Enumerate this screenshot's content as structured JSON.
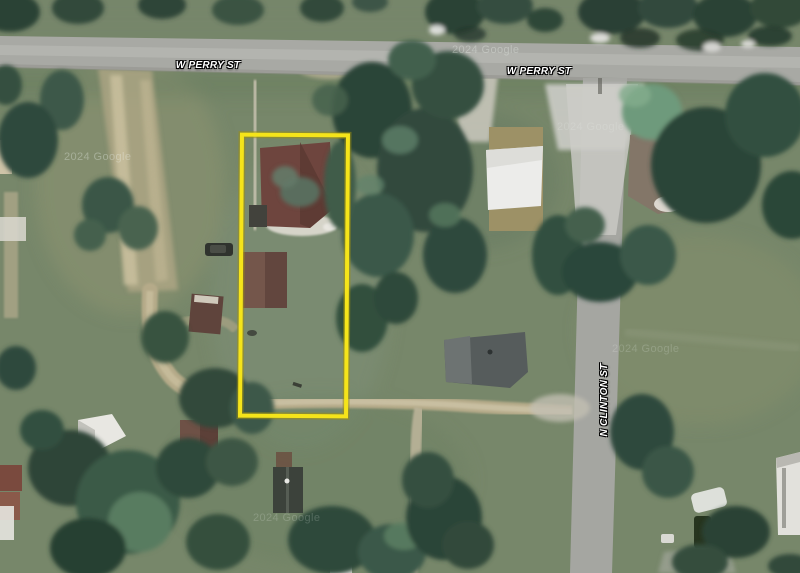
{
  "view": {
    "type": "satellite-map",
    "zoom": "parcel-level aerial imagery"
  },
  "labels": {
    "street_labels": [
      {
        "id": "w-perry-st-west",
        "text": "W PERRY ST",
        "orientation": "horizontal"
      },
      {
        "id": "w-perry-st-east",
        "text": "W PERRY ST",
        "orientation": "horizontal"
      },
      {
        "id": "n-clinton-st",
        "text": "N CLINTON ST",
        "orientation": "vertical"
      }
    ],
    "watermark": "2024 Google"
  },
  "parcel": {
    "highlighted": true,
    "shape": "rectangle",
    "outline_color": "#F5E41A",
    "outline_shadow_color": "#9C8F10"
  },
  "palette": {
    "grass": "#77876A",
    "tree_dark": "#2E4638",
    "tree_light": "#6E9A7C",
    "road_gray": "#A7A8A3",
    "road_light": "#C8C8C3",
    "dirt_path": "#B5AA89",
    "roof_red_brown": "#6E453E",
    "roof_brown": "#74564B",
    "roof_white": "#ECECEA",
    "roof_slate": "#565C5C",
    "roof_olive": "#9D9166"
  }
}
